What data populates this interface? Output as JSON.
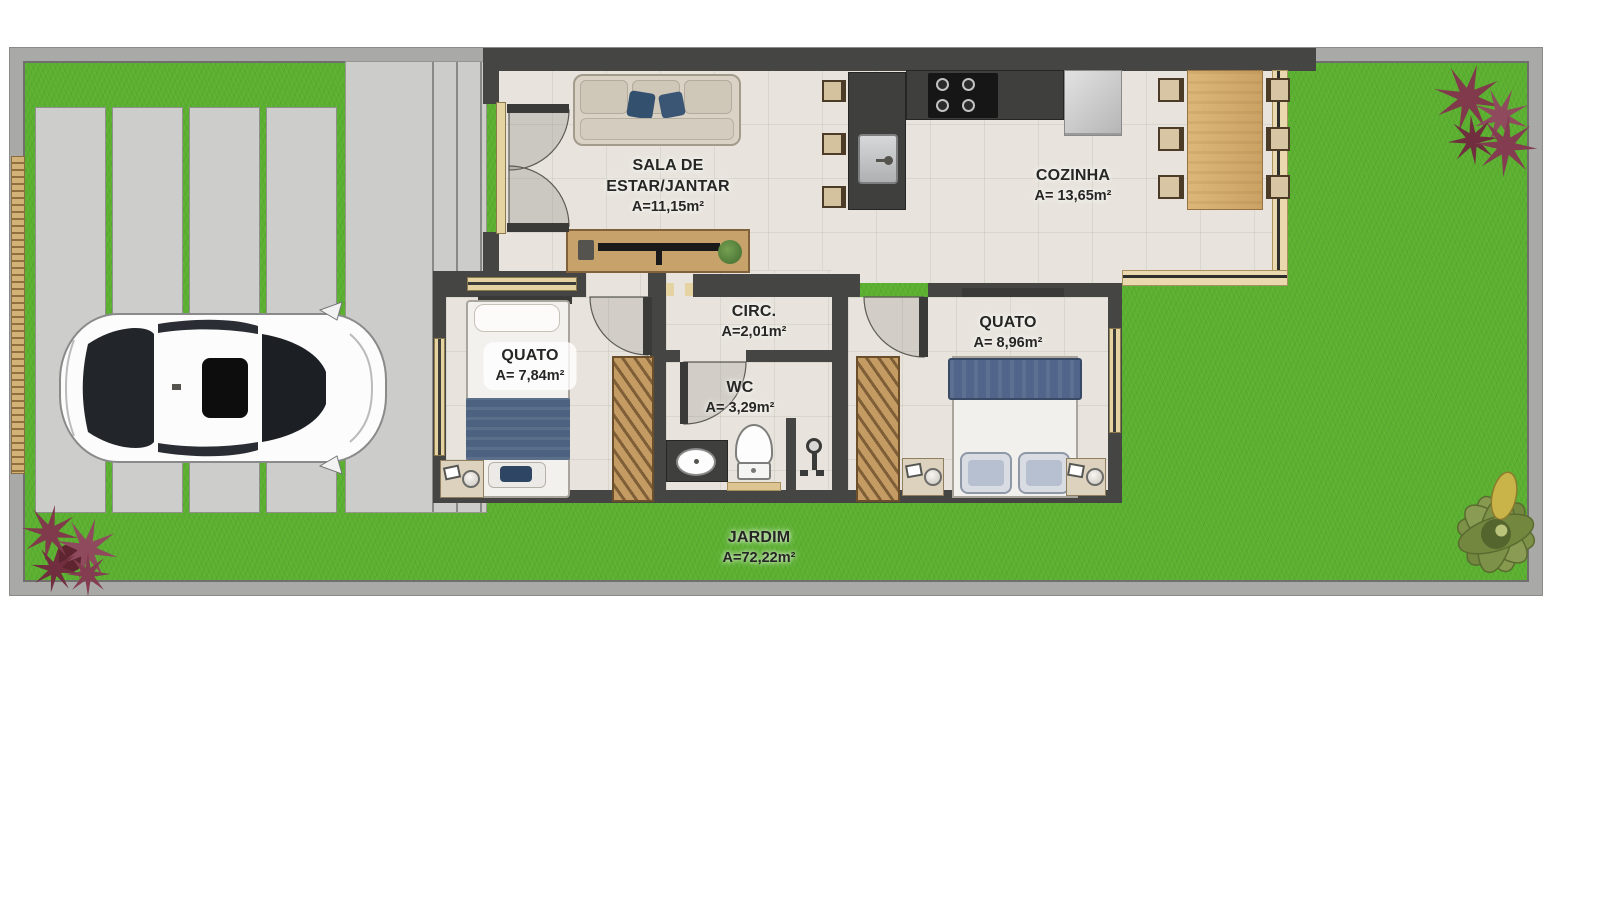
{
  "rooms": {
    "sala": {
      "line1": "SALA DE",
      "line2": "ESTAR/JANTAR",
      "area": "A=11,15m²"
    },
    "cozinha": {
      "name": "COZINHA",
      "area": "A= 13,65m²"
    },
    "circ": {
      "name": "CIRC.",
      "area": "A=2,01m²"
    },
    "quarto1": {
      "name": "QUATO",
      "area": "A= 7,84m²"
    },
    "wc": {
      "name": "WC",
      "area": "A= 3,29m²"
    },
    "quarto2": {
      "name": "QUATO",
      "area": "A= 8,96m²"
    },
    "jardim": {
      "name": "JARDIM",
      "area": "A=72,22m²"
    }
  },
  "colors": {
    "grass": "#5bb030",
    "wall": "#454543",
    "floor": "#e8e4dd",
    "concrete": "#cccccb",
    "wood": "#c8a26b",
    "counter": "#3f3f3d",
    "bed_blue": "#51658a",
    "window_frame": "#e6d3a2",
    "plant_red": "#8a3d4e",
    "plant_green": "#7e9148"
  },
  "objects": {
    "car": "white-car-top-view",
    "sofa": "sofa-with-pillows",
    "tv_rack": "tv-rack",
    "kitchen_island": "kitchen-island-with-sink",
    "cooktop": "gas-cooktop",
    "fridge": "refrigerator",
    "dining_table": "dining-table-with-six-chairs",
    "bed_single": "single-bed",
    "bed_double": "double-bed",
    "wardrobe": "wardrobe",
    "toilet": "toilet",
    "bathroom_sink": "bathroom-sink",
    "shower": "shower",
    "plants": "ornamental-plants",
    "driveway": "driveway-concrete-pads",
    "gate": "front-gate"
  }
}
